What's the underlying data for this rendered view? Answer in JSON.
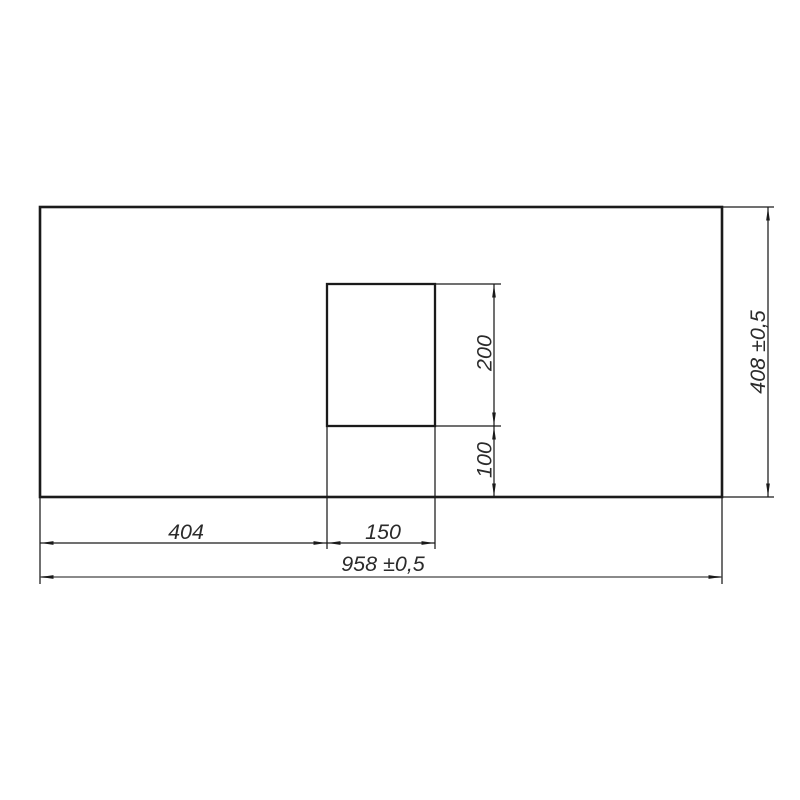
{
  "drawing": {
    "kind": "technical-dimension-drawing",
    "colors": {
      "background": "#ffffff",
      "line": "#1a1a1a",
      "overall_width_dim_line": "#8a8a8a",
      "text": "#2b2b2b"
    },
    "dimensions": {
      "cutout_offset_left": {
        "label": "404"
      },
      "cutout_width": {
        "label": "150"
      },
      "overall_width": {
        "label": "958 ±0,5"
      },
      "cutout_height": {
        "label": "200"
      },
      "cutout_offset_bottom": {
        "label": "100"
      },
      "overall_height": {
        "label": "408 ±0,5"
      }
    }
  }
}
